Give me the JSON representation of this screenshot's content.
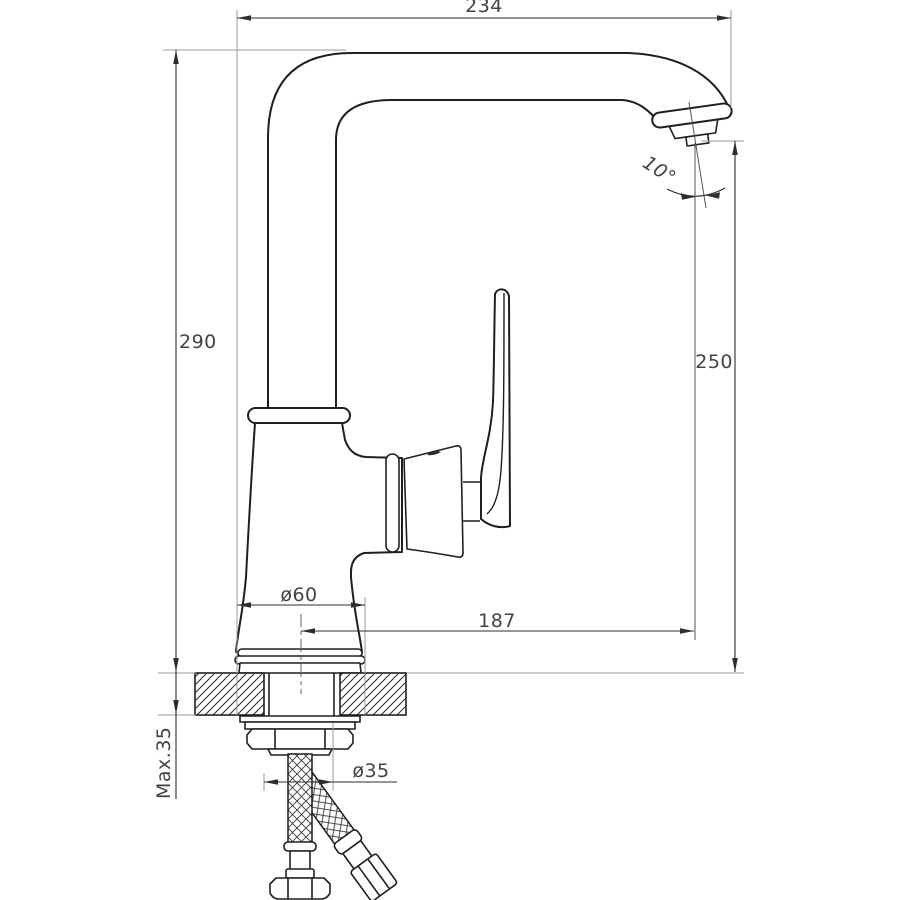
{
  "document": {
    "type": "technical-drawing",
    "subject": "single-lever kitchen faucet, side elevation with installation dimensions"
  },
  "colors": {
    "background": "#ffffff",
    "outline": "#1f1f1f",
    "dimension_line": "#2e2e2e",
    "extension_line": "#9b9b9b",
    "label_text": "#434343"
  },
  "labels": {
    "overall_width": "234",
    "overall_height": "290",
    "spout_outlet_height": "250",
    "outlet_angle": "10°",
    "base_diameter": "ø60",
    "spout_reach": "187",
    "mounting_hole_diameter": "ø35",
    "max_counter_thickness": "Max.35"
  }
}
